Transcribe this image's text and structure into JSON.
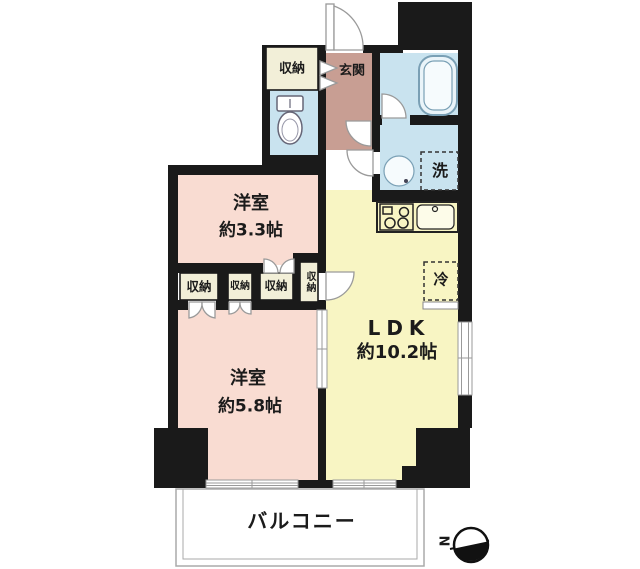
{
  "plan": {
    "rooms": {
      "bedroom_small": {
        "name": "洋室",
        "size": "約3.3帖"
      },
      "bedroom_large": {
        "name": "洋室",
        "size": "約5.8帖"
      },
      "ldk": {
        "name": "LDK",
        "size": "約10.2帖"
      },
      "entrance": {
        "label": "玄関"
      },
      "balcony": {
        "label": "バルコニー"
      }
    },
    "closets": {
      "entry": "収納",
      "row_1": "収納",
      "row_2": "収納",
      "row_3": "収納",
      "row_4": "収納"
    },
    "appliances": {
      "washer": "洗",
      "refrigerator": "冷"
    },
    "compass": {
      "north_label": "N"
    },
    "colors": {
      "wall": "#1a1a1a",
      "bedroom_fill": "#f9dcd2",
      "ldk_fill": "#f8f5c3",
      "wet_area_fill": "#c9e3ef",
      "entrance_fill": "#c89e93",
      "closet_fill": "#f2efd8",
      "balcony_outline": "#aaaaaa"
    }
  }
}
